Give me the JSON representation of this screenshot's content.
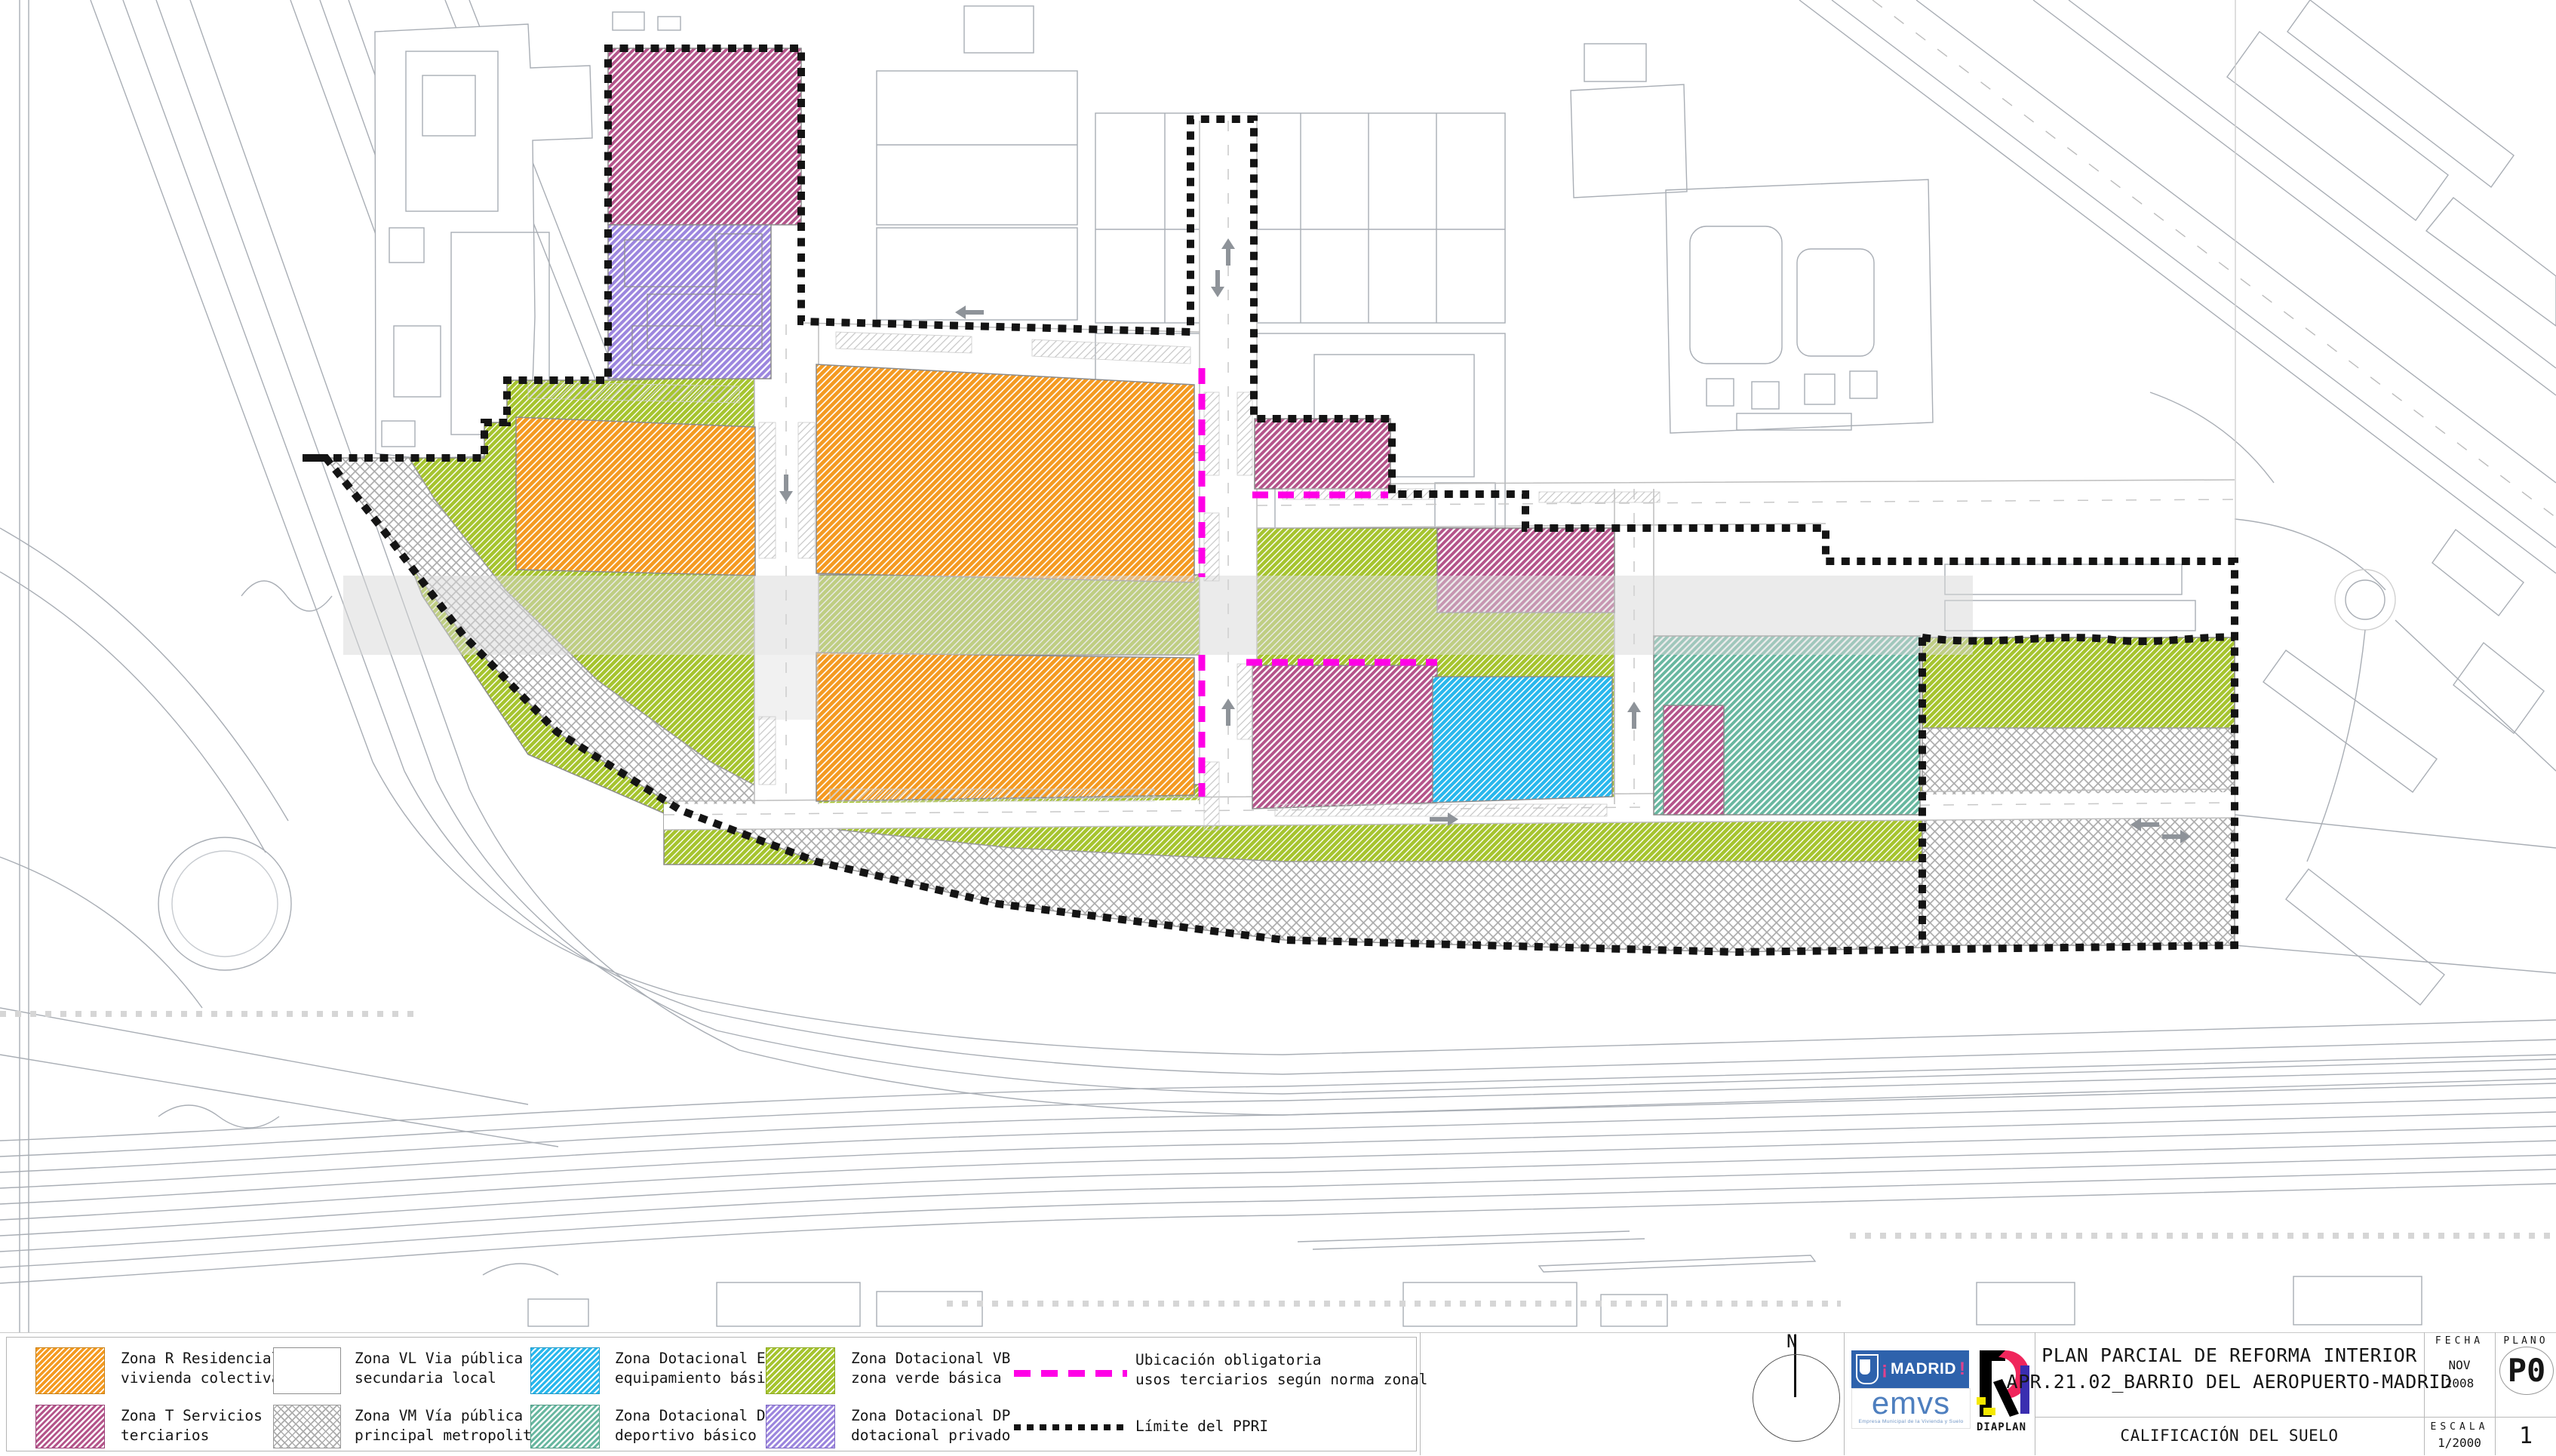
{
  "colors": {
    "residencial": "#F49A21",
    "terciarios": "#B4548A",
    "via_local": "#FFFFFF",
    "via_metropolitana": "#ACACAC",
    "equipamiento": "#29B7EC",
    "deportivo": "#68B7A0",
    "verde": "#A6C42F",
    "privado": "#9C86DE",
    "ubicacion_line": "#FF00E6",
    "limite_line": "#141414",
    "madrid_blue": "#2E62AC"
  },
  "legend": {
    "items": [
      {
        "id": "zona-r",
        "line1": "Zona R Residencial",
        "line2": "vivienda colectiva"
      },
      {
        "id": "zona-t",
        "line1": "Zona T Servicios",
        "line2": "terciarios"
      },
      {
        "id": "zona-vl",
        "line1": "Zona VL Via pública",
        "line2": "secundaria local"
      },
      {
        "id": "zona-vm",
        "line1": "Zona VM Vía pública",
        "line2": "principal metropolitana"
      },
      {
        "id": "zona-eb",
        "line1": "Zona Dotacional EB",
        "line2": "equipamiento básico"
      },
      {
        "id": "zona-db",
        "line1": "Zona Dotacional DB",
        "line2": "deportivo básico"
      },
      {
        "id": "zona-vb",
        "line1": "Zona Dotacional VB",
        "line2": "zona verde básica"
      },
      {
        "id": "zona-dp",
        "line1": "Zona Dotacional DP",
        "line2": "dotacional privado"
      }
    ],
    "lines": [
      {
        "id": "ubicacion",
        "line1": "Ubicación obligatoria",
        "line2": "usos terciarios según norma zonal"
      },
      {
        "id": "limite",
        "line1": "Límite del PPRI"
      }
    ]
  },
  "titleblock": {
    "title_line1": "PLAN PARCIAL DE REFORMA INTERIOR",
    "title_line2": "APR.21.02_BARRIO DEL AEROPUERTO-MADRID",
    "subtitle": "CALIFICACIÓN DEL SUELO",
    "fecha_label": "FECHA",
    "fecha_month": "NOV",
    "fecha_year": "2008",
    "escala_label": "ESCALA",
    "escala_value": "1/2000",
    "plano_label": "PLANO",
    "plano_code": "P0",
    "sheet_number": "1"
  },
  "north": {
    "label": "N"
  },
  "logos": {
    "madrid": "MADRID",
    "emvs": "emvs",
    "emvs_caption": "Empresa Municipal de la Vivienda y Suelo",
    "diaplan": "DIAPLAN"
  }
}
